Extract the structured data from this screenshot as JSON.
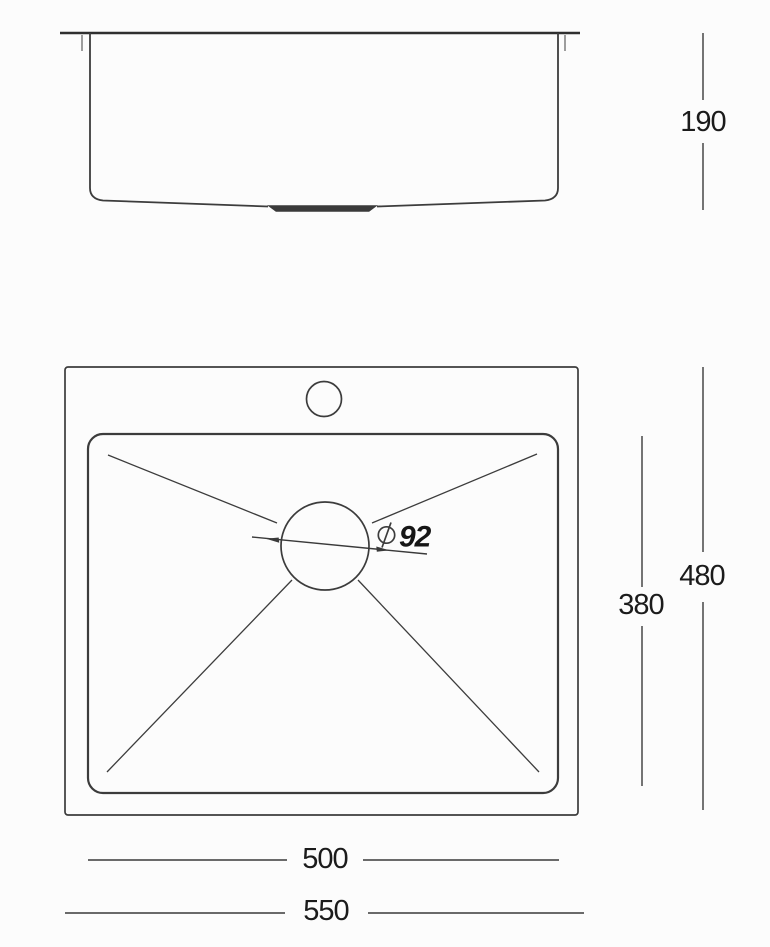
{
  "drawing": {
    "subject": "sink dimension drawing - front elevation and plan view",
    "colors": {
      "background": "#fcfcfc",
      "line": "#3c3c3c",
      "text": "#1b1b1b"
    },
    "side_view": {
      "height": {
        "value": "190"
      }
    },
    "plan_view": {
      "bowl_height": {
        "value": "380"
      },
      "overall_height": {
        "value": "480"
      },
      "bowl_width": {
        "value": "500"
      },
      "overall_width": {
        "value": "550"
      },
      "drain": {
        "diameter_symbol": "⌀",
        "diameter_value": "92"
      }
    }
  }
}
